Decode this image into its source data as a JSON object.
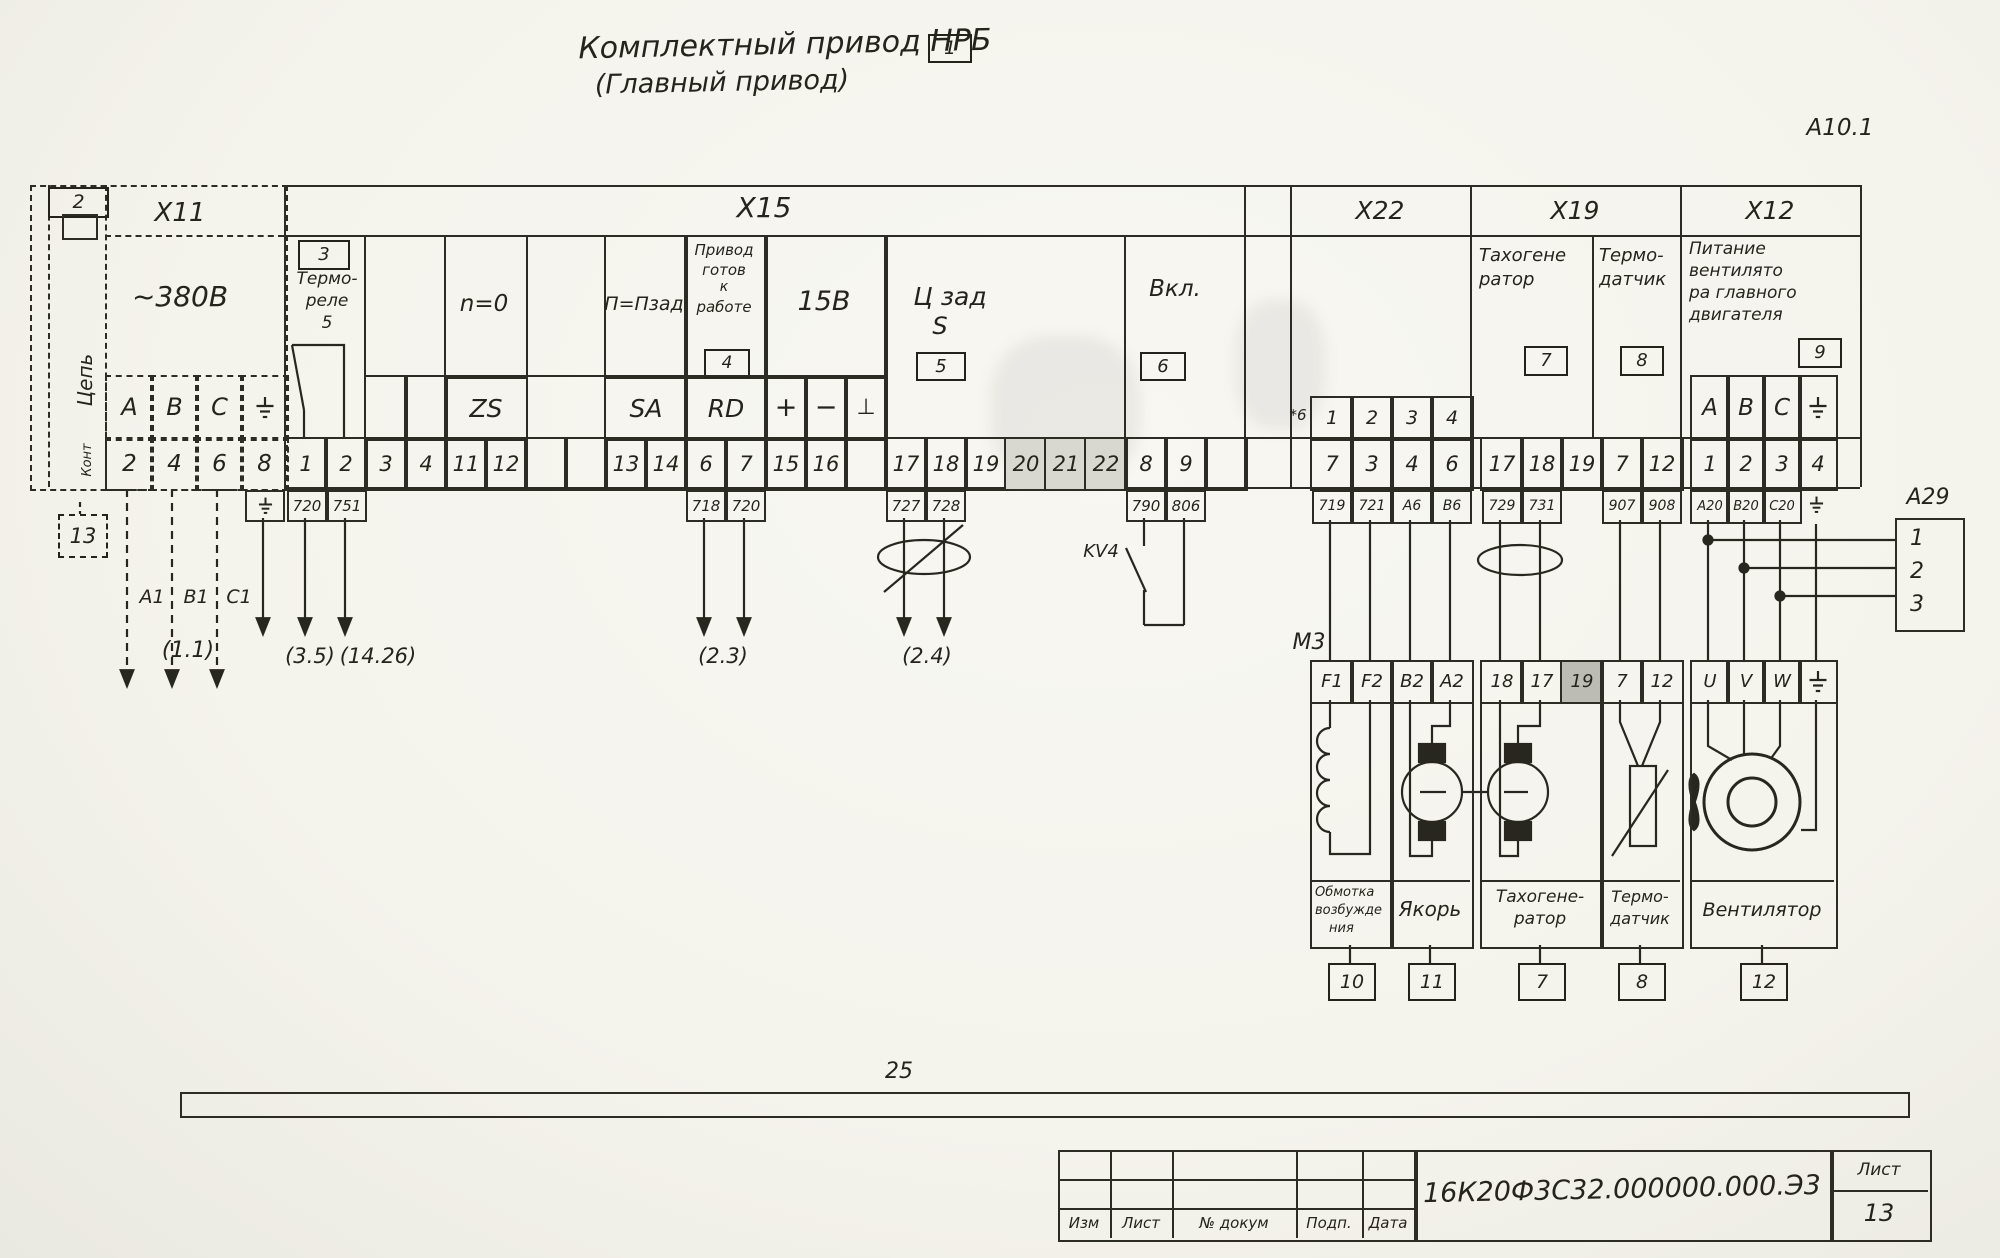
{
  "title": {
    "line1": "Комплектный привод НРБ",
    "sheet_ref": "1",
    "line2": "(Главный привод)"
  },
  "corner_ref": "А10.1",
  "x11": {
    "header": "Х11",
    "ref_top": "2",
    "ref_bottom": "13",
    "voltage": "~380В",
    "col_circuit": "Цепь",
    "col_contact": "Конт",
    "labels": [
      "А",
      "В",
      "С"
    ],
    "contacts": [
      "2",
      "4",
      "6",
      "8"
    ],
    "phase_refs": [
      "А1",
      "В1",
      "С1"
    ],
    "dest_ref": "(1.1)"
  },
  "x15": {
    "header": "Х15",
    "thermo_relay": {
      "ref": "3",
      "line1": "Термо-",
      "line2": "реле",
      "line3": "5"
    },
    "n_zero": "n=0",
    "p_pzad": "П=Пзад",
    "drive_ready": {
      "l1": "Привод",
      "l2": "готов",
      "l3": "к",
      "l4": "работе",
      "ref": "4"
    },
    "v15": "15В",
    "c_zad": {
      "l1": "Ц зад",
      "l2": "S",
      "ref": "5"
    },
    "vkl": {
      "label": "Вкл.",
      "ref": "6"
    },
    "row_labels": {
      "zs": "ZS",
      "sa": "SA",
      "rd": "RD",
      "plus": "+",
      "minus": "−",
      "perp": "⊥"
    },
    "contacts": [
      "1",
      "2",
      "3",
      "4",
      "11",
      "12",
      "",
      "",
      "13",
      "14",
      "6",
      "7",
      "15",
      "16",
      "",
      "17",
      "18",
      "19",
      "20",
      "21",
      "22",
      "8",
      "9",
      ""
    ],
    "wires": [
      "720",
      "751",
      "718",
      "720",
      "727",
      "728",
      "790",
      "806"
    ],
    "kv4": "KV4",
    "dest_refs": {
      "r35": "(3.5)",
      "r1426": "(14.26)",
      "r23": "(2.3)",
      "r24": "(2.4)"
    }
  },
  "x22": {
    "header": "Х22",
    "note": "*6",
    "labels": [
      "1",
      "2",
      "3",
      "4"
    ],
    "contacts": [
      "7",
      "3",
      "4",
      "6"
    ],
    "wires": [
      "719",
      "721",
      "А6",
      "В6"
    ]
  },
  "x19": {
    "header": "Х19",
    "tacho_l1": "Тахогене",
    "tacho_l2": "ратор",
    "tacho_ref": "7",
    "thermo_l1": "Термо-",
    "thermo_l2": "датчик",
    "thermo_ref": "8",
    "contacts": [
      "17",
      "18",
      "19",
      "7",
      "12"
    ],
    "wires": [
      "729",
      "731",
      "907",
      "908"
    ]
  },
  "x12": {
    "header": "Х12",
    "feed_l1": "Питание",
    "feed_l2": "вентилято",
    "feed_l3": "ра главного",
    "feed_l4": "двигателя",
    "ref": "9",
    "labels": [
      "А",
      "В",
      "С"
    ],
    "contacts": [
      "1",
      "2",
      "3",
      "4"
    ],
    "wires": [
      "А20",
      "В20",
      "С20"
    ]
  },
  "a29": {
    "label": "А29",
    "pins": [
      "1",
      "2",
      "3"
    ]
  },
  "m3": {
    "label": "М3",
    "terminals": [
      "F1",
      "F2",
      "В2",
      "А2",
      "18",
      "17",
      "19",
      "7",
      "12",
      "U",
      "V",
      "W"
    ],
    "sections": [
      {
        "l1": "Обмотка",
        "l2": "возбужде",
        "l3": "ния",
        "ref": "10"
      },
      {
        "l1": "Якорь",
        "ref": "11"
      },
      {
        "l1": "Тахогене-",
        "l2": "ратор",
        "ref": "7"
      },
      {
        "l1": "Термо-",
        "l2": "датчик",
        "ref": "8"
      },
      {
        "l1": "Вентилятор",
        "ref": "12"
      }
    ]
  },
  "bus_ref": "25",
  "title_block": {
    "cols": [
      "Изм",
      "Лист",
      "№ докум",
      "Подп.",
      "Дата"
    ],
    "doc_number": "16К20Ф3С32.000000.000.Э3",
    "sheet_label": "Лист",
    "sheet_number": "13"
  },
  "icons": [
    "ground-icon",
    "shield-oval-icon",
    "fan-icon",
    "motor-armature-icon",
    "coil-icon",
    "thermistor-icon",
    "kv4-contact-icon"
  ]
}
